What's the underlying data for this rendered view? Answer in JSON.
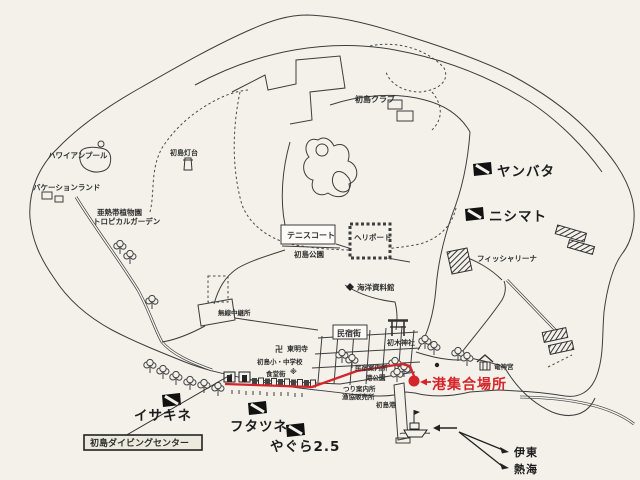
{
  "map": {
    "labels": {
      "hawaiian_pool": "ハワイアンプール",
      "vacation_land": "バケーションランド",
      "lighthouse": "初島灯台",
      "garden1": "亜熱帯植物園",
      "garden2": "トロピカルガーデン",
      "club": "初島クラブ",
      "tennis": "テニスコート",
      "park": "初島公園",
      "heliport": "ヘリポート",
      "museum": "海洋資料館",
      "relay": "無線中継所",
      "fisherina": "フィッシャリーナ",
      "minshuku_box": "民宿街",
      "hatsuki": "初木神社",
      "manji": "卍",
      "tomeiji": "東明寺",
      "school": "初島小・中学校",
      "asterisk": "※",
      "shokudo": "食堂街",
      "minshuku_info": "民宿案内所",
      "tsuri": "つり案内所",
      "gyokyo": "漁協販売所",
      "port_park": "港公園",
      "port": "初島港",
      "ryujin": "竜神宮",
      "meeting": "港集合場所",
      "yanbata": "ヤンバタ",
      "nishimato": "ニシマト",
      "isakine": "イサキネ",
      "futatsune": "フタツネ",
      "yagura": "やぐら2.5",
      "diving_center": "初島ダイビングセンター",
      "ito": "伊東",
      "atami": "熱海"
    },
    "colors": {
      "paper": "#f3f1ea",
      "ink": "#3d3d3d",
      "route_red": "#d5252a",
      "flag_black": "#111111"
    }
  }
}
